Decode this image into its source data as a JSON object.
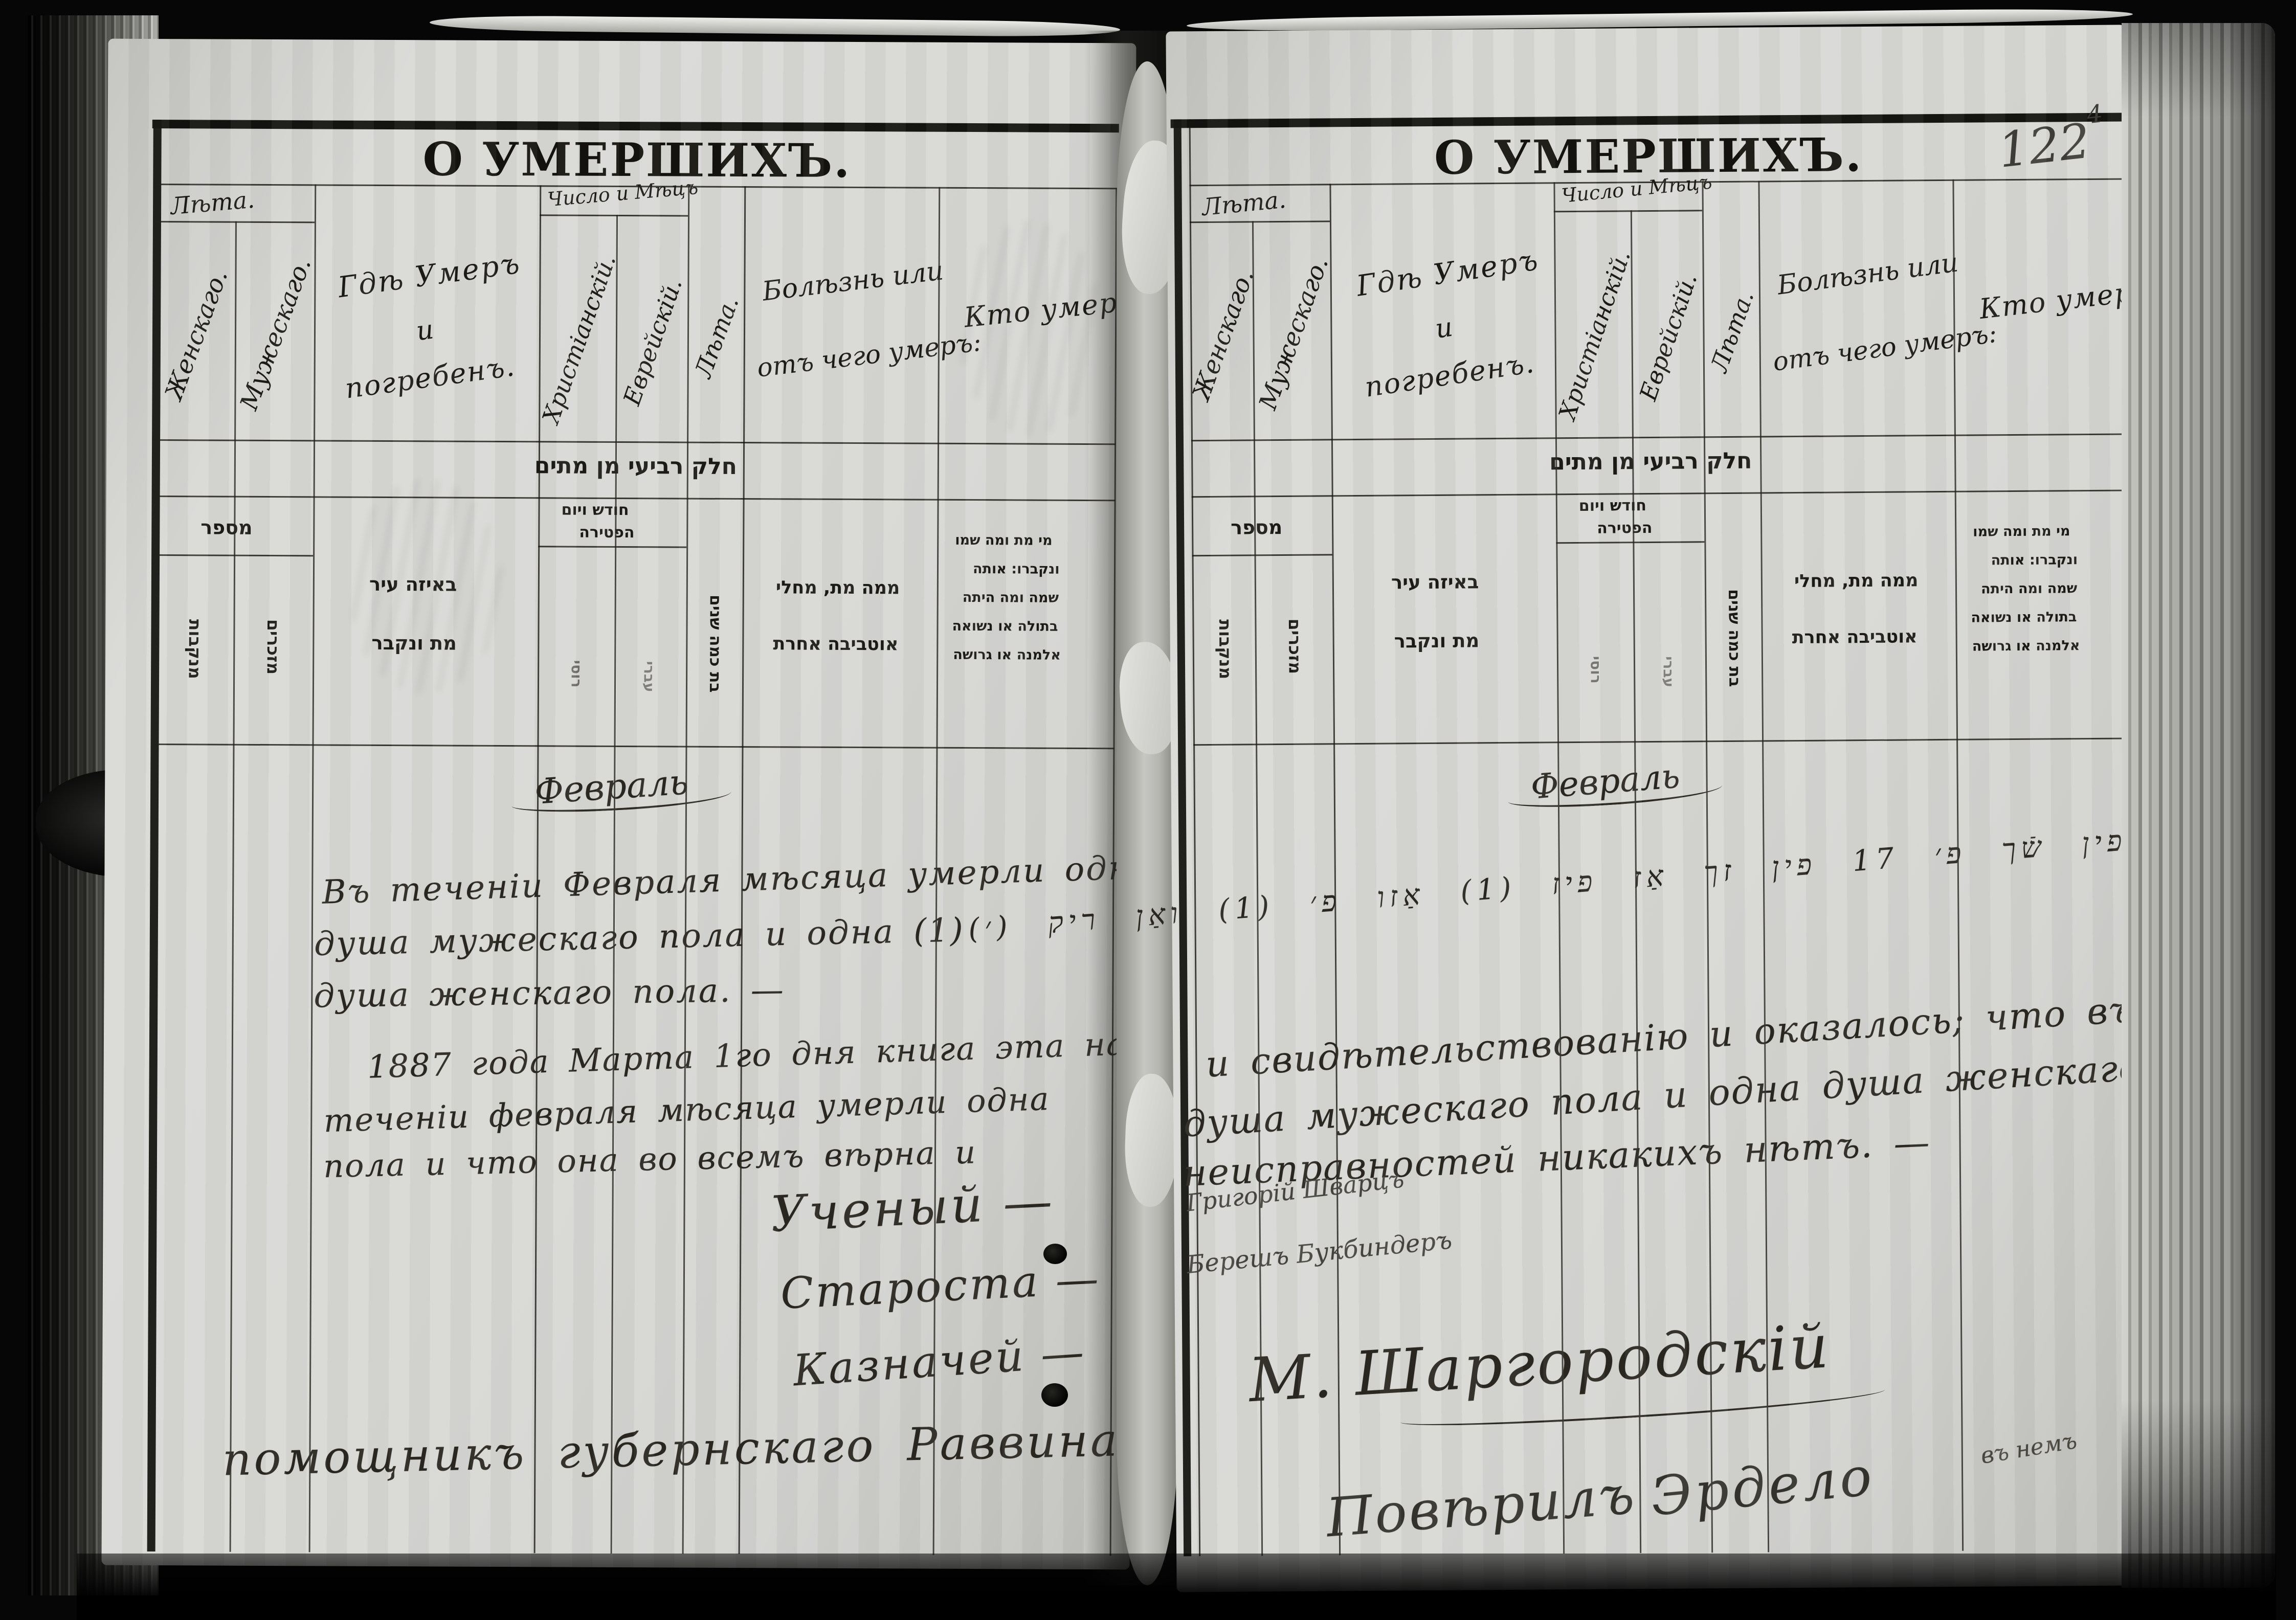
{
  "title": "О УМЕРШИХЪ.",
  "page_number": {
    "main": "122",
    "sup": "4"
  },
  "ru_columns": {
    "age_group": "Лѣта.",
    "female": "Женскаго.",
    "male": "Мужескаго.",
    "where_line1": "Гдѣ Умеръ",
    "where_line2": "и",
    "where_line3": "погребенъ.",
    "date_group": "Число и Мѣцъ",
    "christian": "Христіанскій.",
    "jewish": "Еврейскій.",
    "age": "Лѣта.",
    "illness_line1": "Болѣзнь или",
    "illness_line2": "отъ чего умеръ:",
    "who": "Кто умеръ."
  },
  "he_columns": {
    "band_title": "חלק רביעי מן מתים",
    "number": "מספר",
    "females": "מנקבות",
    "males": "מזכרים",
    "city_line1": "באיזה עיר",
    "city_line2": "מת ונקבר",
    "date_group_line1": "חודש ויום",
    "date_group_line2": "הפטירה",
    "date_rus": "רוסי",
    "date_heb": "עברי",
    "age": "בת כמה שנים",
    "cause_line1": "ממה מת, מחלי",
    "cause_line2": "אוטביבה אחרת",
    "who_line1": "מי מת ומה שמו",
    "who_line2": "ונקברו: אותה",
    "who_line3": "שמה ומה היתה",
    "who_line4": "בתולה או נשואה",
    "who_line5": "אלמנה או גרושה"
  },
  "left_page": {
    "month_heading": "Февраль",
    "para1_line1": "Въ теченіи Февраля мѣсяца умерли одна",
    "para1_line2": "душа мужескаго пола и одна (1)",
    "para1_line3": "душа женскаго пола. —",
    "para2_line1": "1887 года Марта 1го дня книга эта на",
    "para2_line2": "теченіи февраля мѣсяца умерли одна",
    "para2_line3": "пола и что она во всемъ вѣрна и",
    "official1": "Ученый —",
    "official2": "Староста —",
    "official3": "Казначей —",
    "bottom_line": "помощникъ губернскаго Раввина"
  },
  "right_page": {
    "month_heading": "Февраль",
    "yiddish_line": "פ׳ 19 פין שֿך פ׳ 17 פין זך אַז פיז (1) אַזו פ׳ (1) ואַן ריק (׳)",
    "para_line1": "и свидѣтельствованію и оказалось; что въ",
    "para_line2": "душа мужескаго пола и одна душа женскаго",
    "para_line3": "неисправностей никакихъ нѣтъ. —",
    "signature_small1": "Григорій Шварцъ",
    "signature_small2": "Берешъ Букбиндеръ",
    "signature_large": "М. Шаргородскій",
    "signature_bottom1": "Повѣрилъ",
    "signature_bottom2": "Эрдело",
    "signature_note": "въ немъ"
  }
}
